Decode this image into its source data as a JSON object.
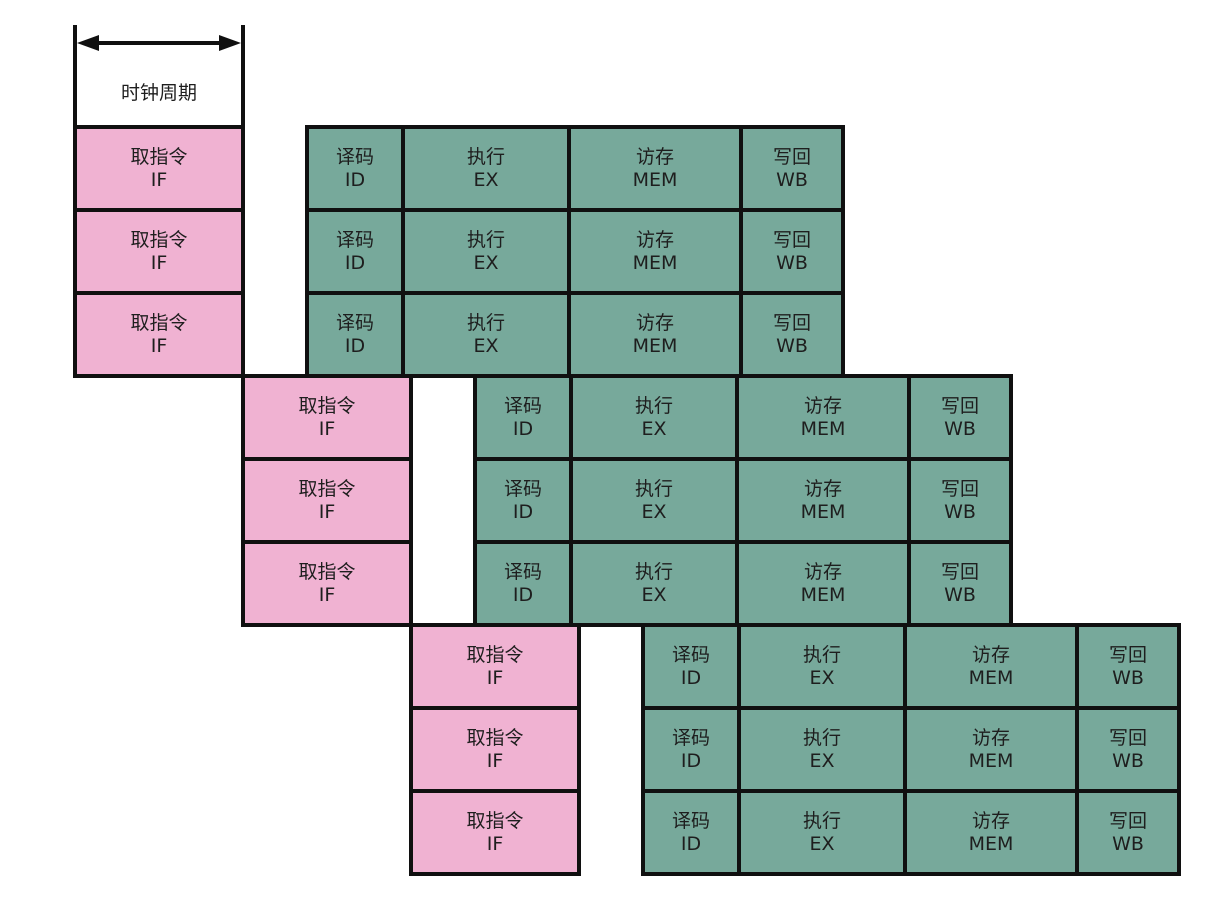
{
  "diagram": {
    "type": "cpu-pipeline-timing-diagram",
    "background": "#ffffff",
    "border_color": "#101010",
    "text_color": "#1e1e1e",
    "clock": {
      "label": "时钟周期"
    },
    "stages": {
      "IF": {
        "zh": "取指令",
        "en": "IF",
        "fill": "#f0b2d2"
      },
      "ID": {
        "zh": "译码",
        "en": "ID",
        "fill": "#77a99b"
      },
      "EX": {
        "zh": "执行",
        "en": "EX",
        "fill": "#77a99b"
      },
      "MEM": {
        "zh": "访存",
        "en": "MEM",
        "fill": "#77a99b"
      },
      "WB": {
        "zh": "写回",
        "en": "WB",
        "fill": "#77a99b"
      }
    },
    "stage_order": [
      "IF",
      "ID",
      "EX",
      "MEM",
      "WB"
    ],
    "instruction_rows": [
      {
        "group": 1
      },
      {
        "group": 1
      },
      {
        "group": 1
      },
      {
        "group": 2
      },
      {
        "group": 2
      },
      {
        "group": 2
      },
      {
        "group": 3
      },
      {
        "group": 3
      },
      {
        "group": 3
      }
    ]
  }
}
